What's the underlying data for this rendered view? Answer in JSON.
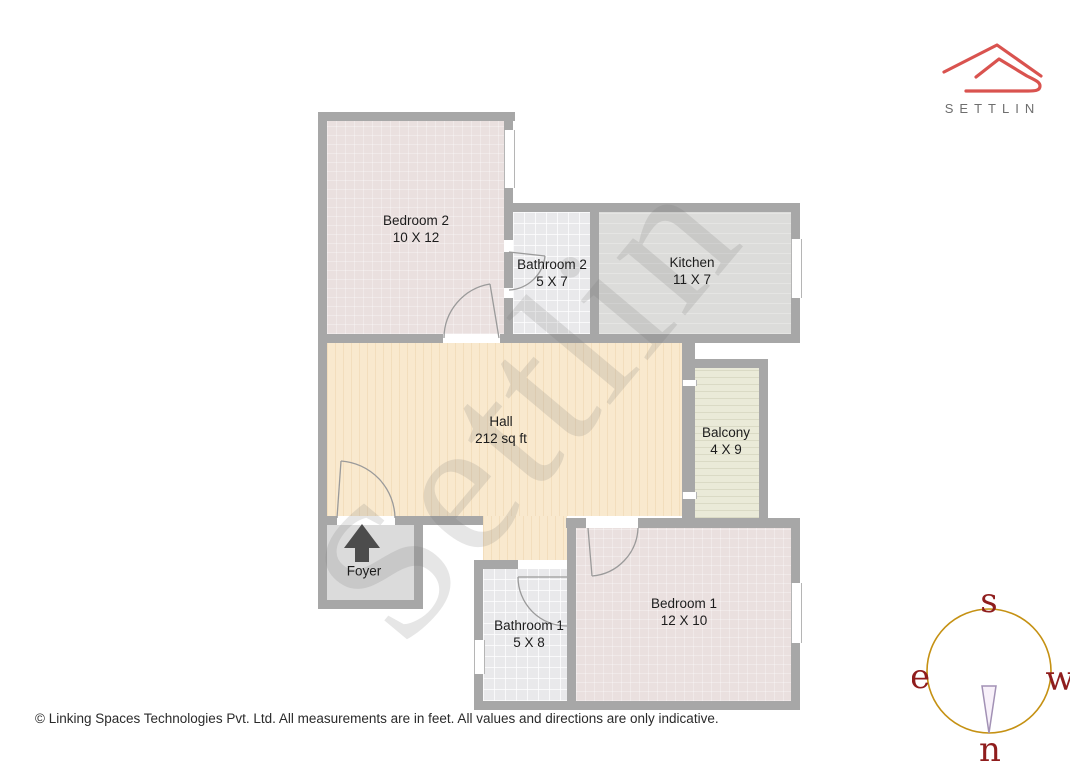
{
  "brand": {
    "name": "SETTLIN",
    "logo_color": "#d9534f",
    "text_color": "#6e6e6e"
  },
  "watermark_text": "Settlin",
  "rooms": [
    {
      "name": "Bedroom 2",
      "dims": "10 X 12",
      "fill": "#eae0df"
    },
    {
      "name": "Bathroom 2",
      "dims": "5 X 7",
      "fill": "#e9e9eb"
    },
    {
      "name": "Kitchen",
      "dims": "11 X 7",
      "fill": "#dcdcda"
    },
    {
      "name": "Hall",
      "dims": "212 sq ft",
      "fill": "#f9e9ce"
    },
    {
      "name": "Balcony",
      "dims": "4 X 9",
      "fill": "#eaead8"
    },
    {
      "name": "Foyer",
      "dims": "",
      "fill": "#dbdbdb"
    },
    {
      "name": "Bathroom 1",
      "dims": "5 X 8",
      "fill": "#e9e9eb"
    },
    {
      "name": "Bedroom 1",
      "dims": "12 X 10",
      "fill": "#eae0df"
    }
  ],
  "plan": {
    "wall_color": "#a7a7a7"
  },
  "compass": {
    "top": "s",
    "left": "e",
    "right": "w",
    "bottom": "n",
    "circle_color": "#c59113",
    "letter_color": "#8f1d1d",
    "needle_outline": "#a291b5",
    "needle_fill": "#f8f1fa"
  },
  "footer": {
    "copyright": "© Linking Spaces Technologies Pvt. Ltd. All measurements are in feet. All values and directions are only indicative."
  }
}
